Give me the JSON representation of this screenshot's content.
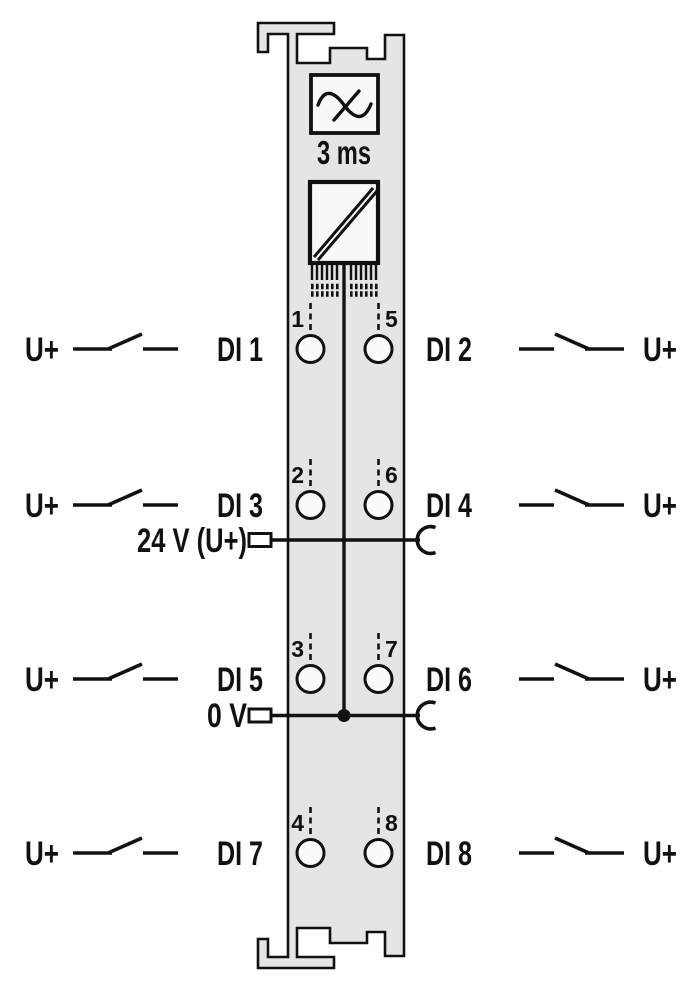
{
  "module": {
    "filter_delay_label": "3 ms",
    "power_rail_top_label": "24 V (U+)",
    "power_rail_bottom_label": "0 V",
    "body_fill": "#e5e5e5",
    "box_fill": "#f8f8f8",
    "line_color": "#111111"
  },
  "icons": {
    "filter": "sine-wave-crossed-icon",
    "isolation": "diagonal-barrier-icon",
    "switch": "normally-open-contact-icon",
    "jumper": "power-jumper-contact-icon"
  },
  "channels": [
    {
      "supply_left": "U+",
      "input_left": "DI 1",
      "terminal_left": "1",
      "terminal_right": "5",
      "input_right": "DI 2",
      "supply_right": "U+"
    },
    {
      "supply_left": "U+",
      "input_left": "DI 3",
      "terminal_left": "2",
      "terminal_right": "6",
      "input_right": "DI 4",
      "supply_right": "U+"
    },
    {
      "supply_left": "U+",
      "input_left": "DI 5",
      "terminal_left": "3",
      "terminal_right": "7",
      "input_right": "DI 6",
      "supply_right": "U+"
    },
    {
      "supply_left": "U+",
      "input_left": "DI 7",
      "terminal_left": "4",
      "terminal_right": "8",
      "input_right": "DI 8",
      "supply_right": "U+"
    }
  ]
}
